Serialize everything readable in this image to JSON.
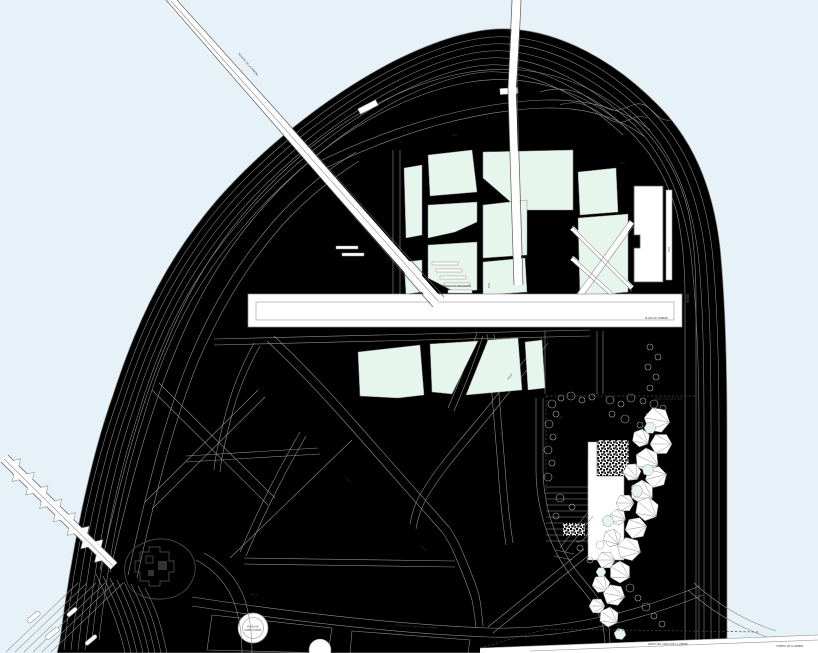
{
  "meta": {
    "title": "Waterfront master plan drawing",
    "type": "architectural site plan"
  },
  "canvas": {
    "width": 818,
    "height": 653
  },
  "colors": {
    "water": "#e6f1f8",
    "land": "#ffffff",
    "green": "#e7f6ec",
    "line": "#8f8f8f",
    "line_dark": "#5a5a5a",
    "text": "#3f3f3f",
    "mosaic": "#111111"
  },
  "labels": {
    "sup_area": "SUP.=24.313 m2",
    "bridge": "PUENTE DE LA RIBERA",
    "parque": "PARQUE DE MIRADORES",
    "plaza_paseo_end": "PLAZA DE CRIBERA",
    "avenida": "AVENIDA DEL CANTO DE LA RIBERA",
    "paseo_bottom": "PASEO DEL CANTO DE LA RIBERA",
    "puerto": "PUERTO DE LA RIBERA",
    "torre_line1": "TORRE DE",
    "torre_line2": "CALAHORRA",
    "plaza_tomas_line1": "PLAZA DE",
    "plaza_tomas_line2": "SANTO TOMAS",
    "vial": "VIAL",
    "calle": "CALLE"
  }
}
